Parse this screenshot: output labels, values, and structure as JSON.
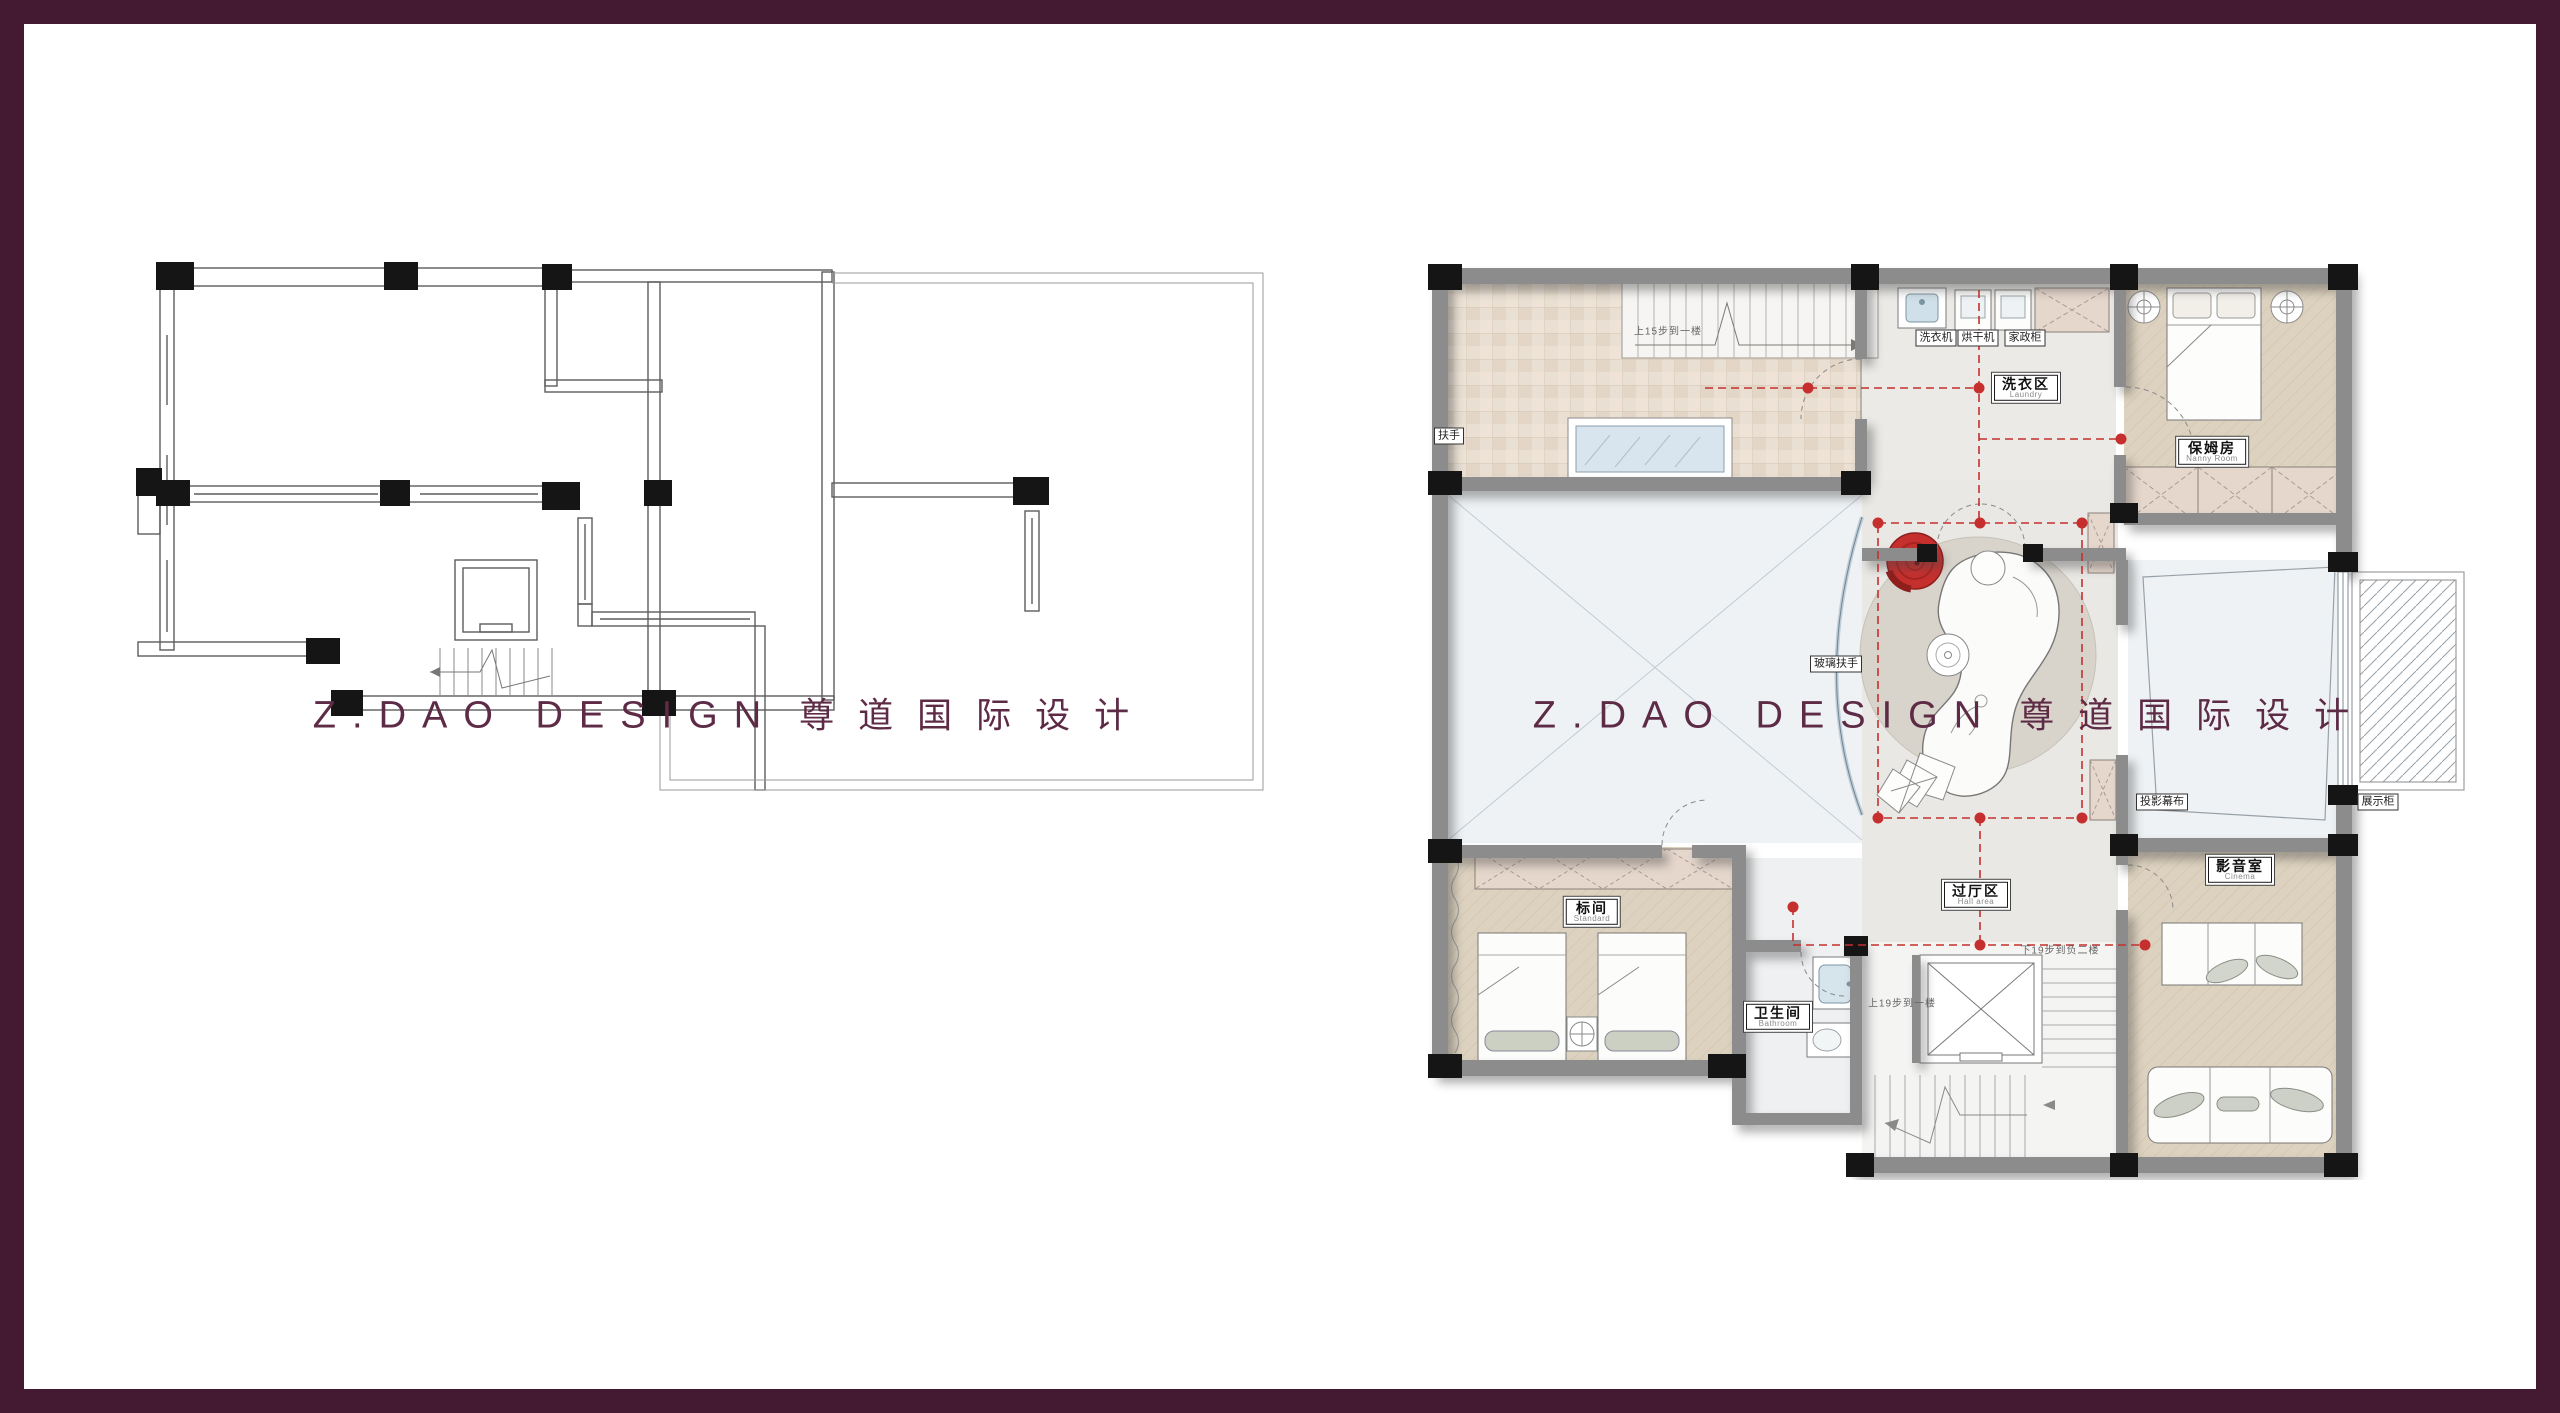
{
  "watermark": {
    "en": "Z.DAO DESIGN",
    "cn": "尊道国际设计",
    "color": "#5e2b46"
  },
  "left_plan": {
    "description": "original structure plan (blank walls, columns, windows, elevator and stairs)"
  },
  "right_plan": {
    "rooms": {
      "laundry": {
        "cn": "洗衣区",
        "en": "Laundry"
      },
      "nanny": {
        "cn": "保姆房",
        "en": "Nanny Room"
      },
      "standard": {
        "cn": "标间",
        "en": "Standard"
      },
      "bathroom": {
        "cn": "卫生间",
        "en": "Bathroom"
      },
      "hall": {
        "cn": "过厅区",
        "en": "Hall area"
      },
      "cinema": {
        "cn": "影音室",
        "en": "Cinema"
      }
    },
    "callouts": {
      "handrail": "扶手",
      "glass_handrail": "玻璃扶手",
      "washer": "洗衣机",
      "dryer": "烘干机",
      "cabinet": "家政柜",
      "projection_screen": "投影幕布",
      "display_cabinet": "展示柜"
    },
    "stairs": {
      "up15": "上15步到一楼",
      "up19": "上19步到一楼",
      "down19": "下19步到负二楼"
    }
  },
  "colors": {
    "frame": "#441a32",
    "watermark": "#5e2b46",
    "wall_gray": "#8c8c8c",
    "column_black": "#151515",
    "accent_red": "#c5302e",
    "wood_floor": "#ddd2bf",
    "terrace_tile": "#e9dfd3",
    "closet_beige": "#e6d7cc",
    "void_blue": "#eef2f4",
    "glass_blue": "#d8e5ee"
  }
}
